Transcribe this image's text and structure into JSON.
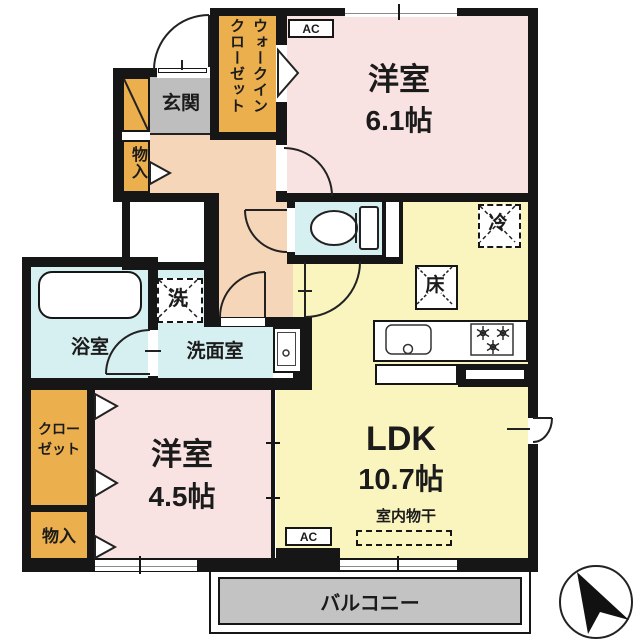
{
  "plan_title": "2LDK apartment floor plan",
  "rooms": {
    "bedroom1": {
      "name": "洋室",
      "size": "6.1帖"
    },
    "bedroom2": {
      "name": "洋室",
      "size": "4.5帖"
    },
    "ldk": {
      "name": "LDK",
      "size": "10.7帖"
    },
    "entrance": {
      "label": "玄関"
    },
    "bath": {
      "label": "浴室"
    },
    "washroom": {
      "label": "洗面室"
    },
    "wic": {
      "line1": "ウォークイン",
      "line2": "クローゼット"
    },
    "closet": {
      "line1": "クロー",
      "line2": "ゼット"
    },
    "storage_upper": {
      "label": "物入"
    },
    "storage_lower": {
      "label": "物入"
    },
    "balcony": {
      "label": "バルコニー"
    }
  },
  "annotations": {
    "ac_upper": "AC",
    "ac_lower": "AC",
    "washer": "洗",
    "fridge": "冷",
    "floor_storage": "床",
    "indoor_drying": "室内物干"
  },
  "colors": {
    "wall": "#161616",
    "bedroom_pink": "#f9e3e2",
    "ldk_yellow": "#faf5bf",
    "hall_peach": "#f6d6b8",
    "wet_cyan": "#d6f0f2",
    "storage_orange": "#ecaf4d",
    "entrance_gray": "#bfbebe",
    "balcony_gray": "#c3c3c3"
  }
}
